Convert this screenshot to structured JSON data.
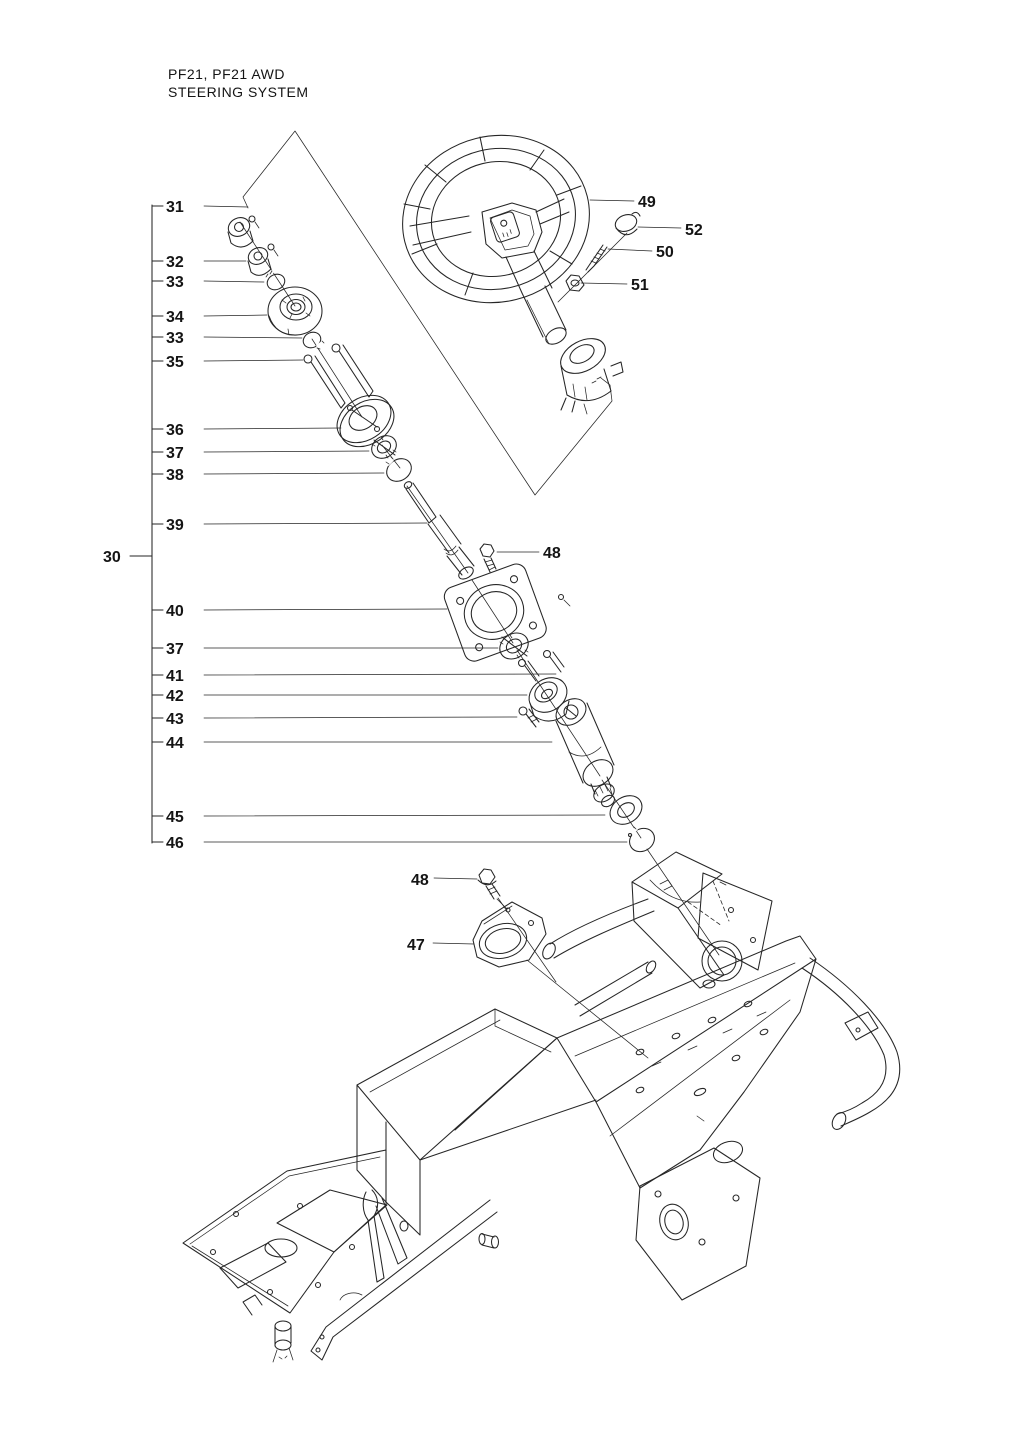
{
  "title": {
    "line1": "PF21, PF21 AWD",
    "line2": "STEERING SYSTEM"
  },
  "colors": {
    "ink": "#262626",
    "paper": "#ffffff"
  },
  "callouts": {
    "group_label": "30",
    "column": [
      "31",
      "32",
      "33",
      "34",
      "33",
      "35",
      "36",
      "37",
      "38",
      "39",
      "40",
      "37",
      "41",
      "42",
      "43",
      "44",
      "45",
      "46"
    ],
    "wheel": [
      "49",
      "52",
      "50",
      "51"
    ],
    "upper_bolt": "48",
    "lower_bolt": "48",
    "bracket_plate": "47"
  }
}
